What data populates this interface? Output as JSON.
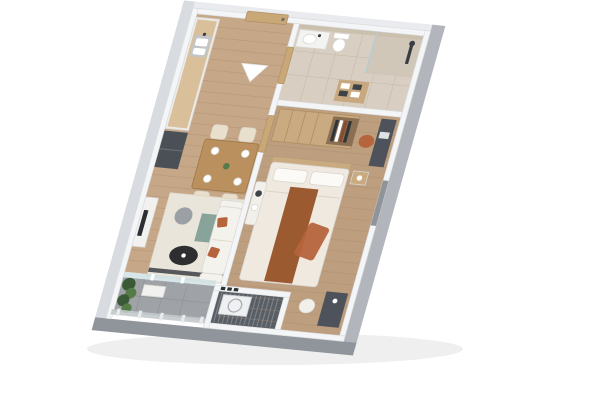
{
  "meta": {
    "description": "3D isometric cutaway render of a one-bedroom apartment floor plan on a white background, entrance at top, balcony at bottom",
    "view": "isometric-top-down",
    "width": 600,
    "height": 400
  },
  "rooms": [
    {
      "name": "entry-hall",
      "features": [
        "entrance-door",
        "direction-arrow"
      ]
    },
    {
      "name": "kitchen",
      "features": [
        "counter",
        "double-sink",
        "refrigerator"
      ]
    },
    {
      "name": "dining-area",
      "features": [
        "wood-table",
        "four-cream-chairs",
        "plates",
        "centerpiece"
      ]
    },
    {
      "name": "living-area",
      "features": [
        "white-sofa",
        "rust-pillows",
        "black-coffee-table",
        "cream-rug",
        "gray-pouf",
        "tv-console"
      ]
    },
    {
      "name": "bathroom",
      "features": [
        "walk-in-shower",
        "toilet",
        "vanity-basin",
        "towel-shelf",
        "wood-door"
      ]
    },
    {
      "name": "bedroom",
      "features": [
        "double-bed",
        "rust-runner",
        "wardrobe-with-books",
        "desk",
        "orange-chair",
        "bench",
        "nightstand",
        "vanity-table",
        "white-chair"
      ]
    },
    {
      "name": "balcony",
      "features": [
        "green-plants",
        "planter-bench",
        "glass-railing",
        "sliding-glass-door",
        "gray-tile-floor"
      ]
    },
    {
      "name": "technical-closet",
      "features": [
        "ac-unit",
        "louvered-floor",
        "vent-grilles"
      ]
    }
  ],
  "palette": {
    "bg": "#ffffff",
    "shadow": "#1a1a1a",
    "wall_top": "#f4f5f6",
    "wall_face_right": "#b2b6bc",
    "wall_face_bottom": "#8f959b",
    "wall_face_left": "#d8dbdf",
    "wall_face_top": "#e9ebee",
    "floor_living": "#c6a788",
    "floor_bedroom": "#bd9e7f",
    "floor_bath": "#d8cec1",
    "bath_band": "#cbbfae",
    "shower_floor": "#cfc5b7",
    "floor_balcony": "#9fa2a7",
    "floor_tech": "#595e65",
    "glass": "#cfe0e3",
    "door_wood": "#c9a877",
    "handle_dark": "#6b6f75",
    "arrow": "#ffffff",
    "counter_white": "#ecebe7",
    "counter_top": "#d9bf9a",
    "sink_gray": "#c2c6c9",
    "basin_white": "#ffffff",
    "fridge_dark": "#4b5057",
    "table_wood": "#b9905e",
    "chair_cream": "#e8dfcc",
    "plate": "#ffffff",
    "green_dark": "#3a5a36",
    "green": "#557c47",
    "rug": "#e9e5da",
    "rug_teal": "#6f9389",
    "rug_dark": "#3c4045",
    "sofa": "#f4f2ec",
    "rust": "#b5643c",
    "table_black": "#2e2e31",
    "pouf": "#9aa0a3",
    "console": "#f1f1ef",
    "tv": "#2b2e33",
    "vanity": "#f3f3f1",
    "fixture": "#3a3e44",
    "shelf_wood": "#c8a87f",
    "towel_dark": "#3e4348",
    "white": "#ffffff",
    "wardrobe": "#c9aa81",
    "wardrobe_inner": "#8a6f52",
    "book_dark": "#32363b",
    "book_red": "#8a4b2f",
    "desk": "#4e525a",
    "laptop": "#dfe2e4",
    "bed": "#efe9e0",
    "pillow": "#fbfaf7",
    "runner": "#9c5a31",
    "bench": "#f2f0ea",
    "niche": "#8f949b",
    "ac": "#eef0f1",
    "vent": "#2e3134",
    "rail_glass": "#c3c9cc",
    "post": "#e8eaec"
  }
}
